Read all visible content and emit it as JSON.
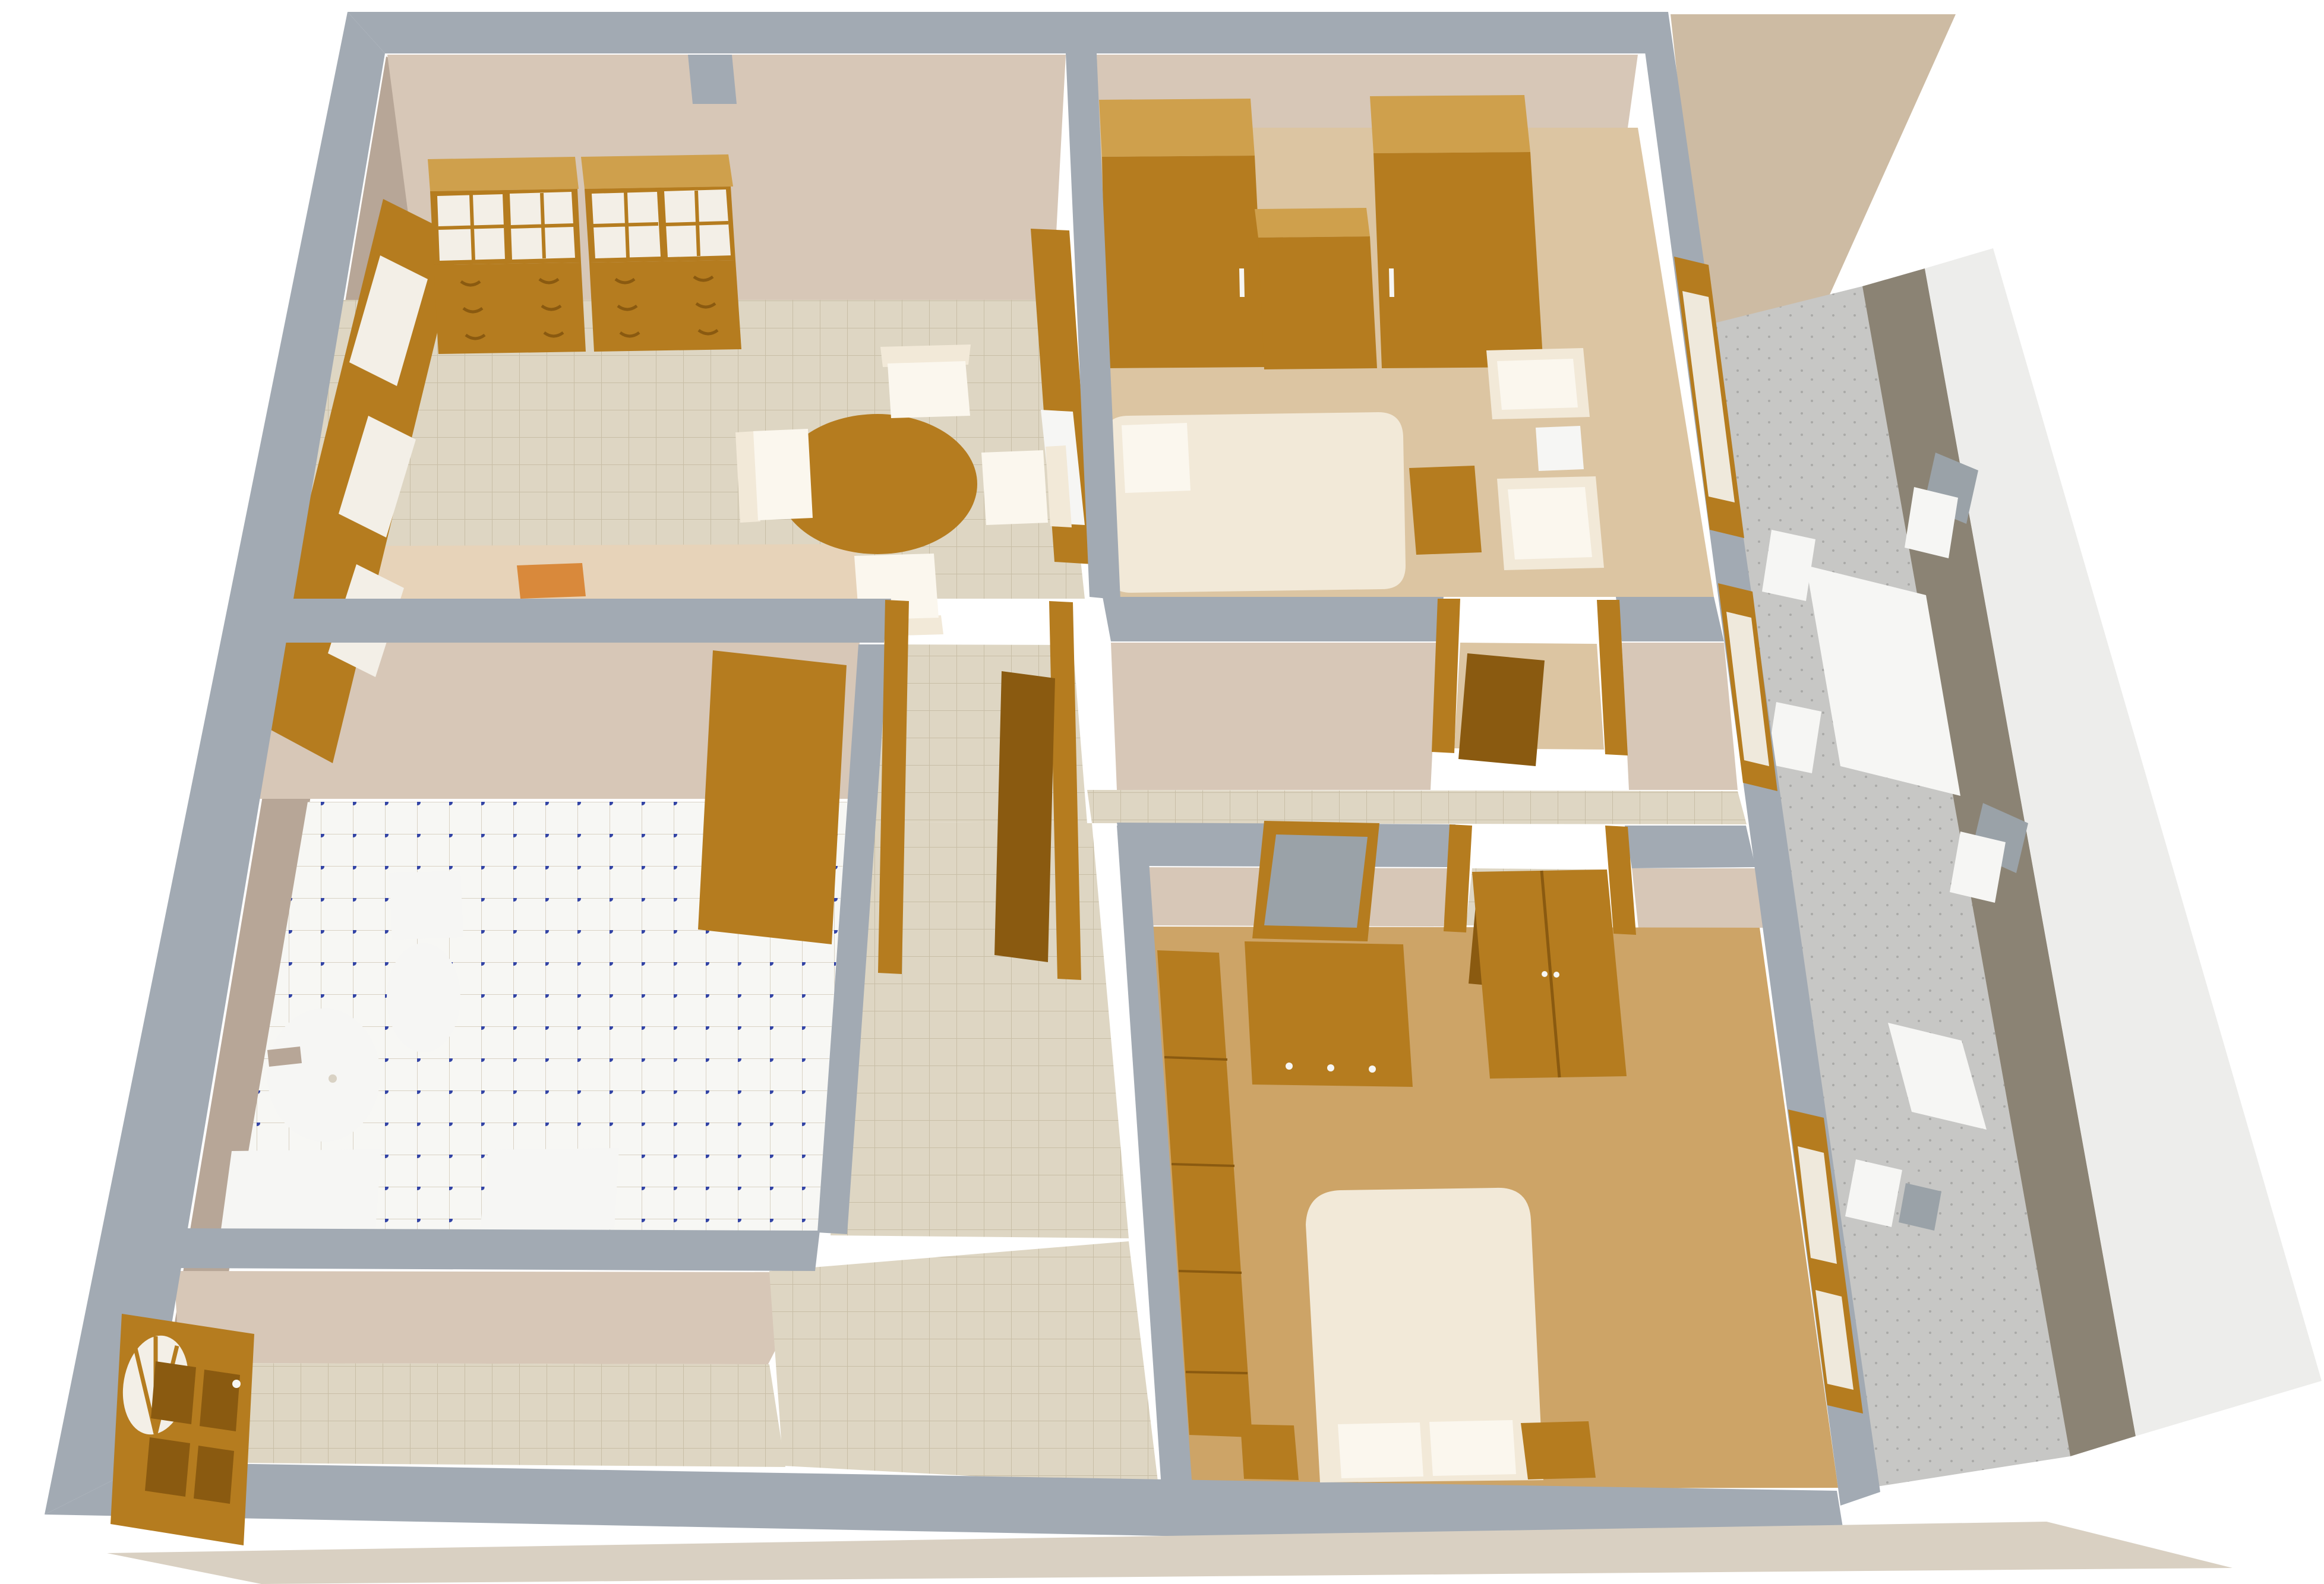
{
  "scene": {
    "type": "3d-floorplan-render",
    "view": "birds-eye-perspective",
    "background": "#ffffff"
  },
  "palette": {
    "wall_top": "#a2aab3",
    "face_tan": "#d7c7b7",
    "face_taupe": "#b7a697",
    "wood": "#b57c1f",
    "wood_dark": "#8a5a10",
    "wood_light": "#cfa04c",
    "tile_floor": "#ded6c3",
    "tile_line": "#c8bea6",
    "bath_tile": "#f7f7f4",
    "bath_line": "#d9d2c4",
    "bath_dot": "#3344a5",
    "carpet_light": "#dcc5a2",
    "carpet_tan": "#cda467",
    "cream": "#f2e9d8",
    "white_fixture": "#f6f6f4",
    "glass_white": "#f3efe7",
    "pane_light": "#efe9dc",
    "pillow_white": "#fbf7ee",
    "balcony_floor": "#c7c7c5",
    "balcony_speck": "#a9a9a7",
    "balcony_rail": "#8b8374",
    "balcony_wall_tan": "#cdbba3",
    "exterior_white": "#ededeb",
    "slab": "#d9d0c2",
    "mirror": "#9aa2a8",
    "mat": "#d9893b",
    "marble": "#e7d3b9"
  },
  "apartment": {
    "rooms": [
      {
        "id": "dining-kitchen",
        "floor_finish": "beige-ceramic-tile",
        "furniture": [
          "china-cabinet-left",
          "china-cabinet-right",
          "kitchen-sink-counter",
          "oval-dining-table",
          "dining-chair-north",
          "dining-chair-east",
          "dining-chair-south",
          "dining-chair-west",
          "west-window",
          "floor-mat",
          "marble-step"
        ]
      },
      {
        "id": "bedroom-1",
        "floor_finish": "light-carpet",
        "furniture": [
          "wardrobe-left",
          "low-chest",
          "wardrobe-right",
          "single-bed",
          "pillow",
          "side-table",
          "armchair-north",
          "armchair-south",
          "footstool",
          "east-window"
        ]
      },
      {
        "id": "bathroom",
        "floor_finish": "white-tile-blue-dots",
        "furniture": [
          "washbasin",
          "faucet",
          "toilet",
          "bath-counter",
          "washing-machine",
          "open-door"
        ]
      },
      {
        "id": "hallway-entry",
        "floor_finish": "beige-ceramic-tile",
        "furniture": [
          "arched-entry-door",
          "dining-door-frame",
          "open-door-leaf"
        ]
      },
      {
        "id": "bedroom-2",
        "floor_finish": "tan-carpet",
        "furniture": [
          "chest-of-drawers",
          "dresser",
          "tilted-mirror",
          "tall-wardrobe",
          "double-bed",
          "pillow-left",
          "pillow-right",
          "nightstand-left",
          "nightstand-right",
          "east-window",
          "room-door"
        ]
      },
      {
        "id": "balcony",
        "floor_finish": "speckled-stone",
        "furniture": [
          "long-table",
          "small-table",
          "white-chair-1",
          "white-chair-2",
          "white-chair-3",
          "white-chair-4",
          "white-chair-5",
          "gray-chair-back-1",
          "gray-chair-back-2",
          "gray-chair-back-3",
          "balcony-door"
        ]
      }
    ]
  }
}
